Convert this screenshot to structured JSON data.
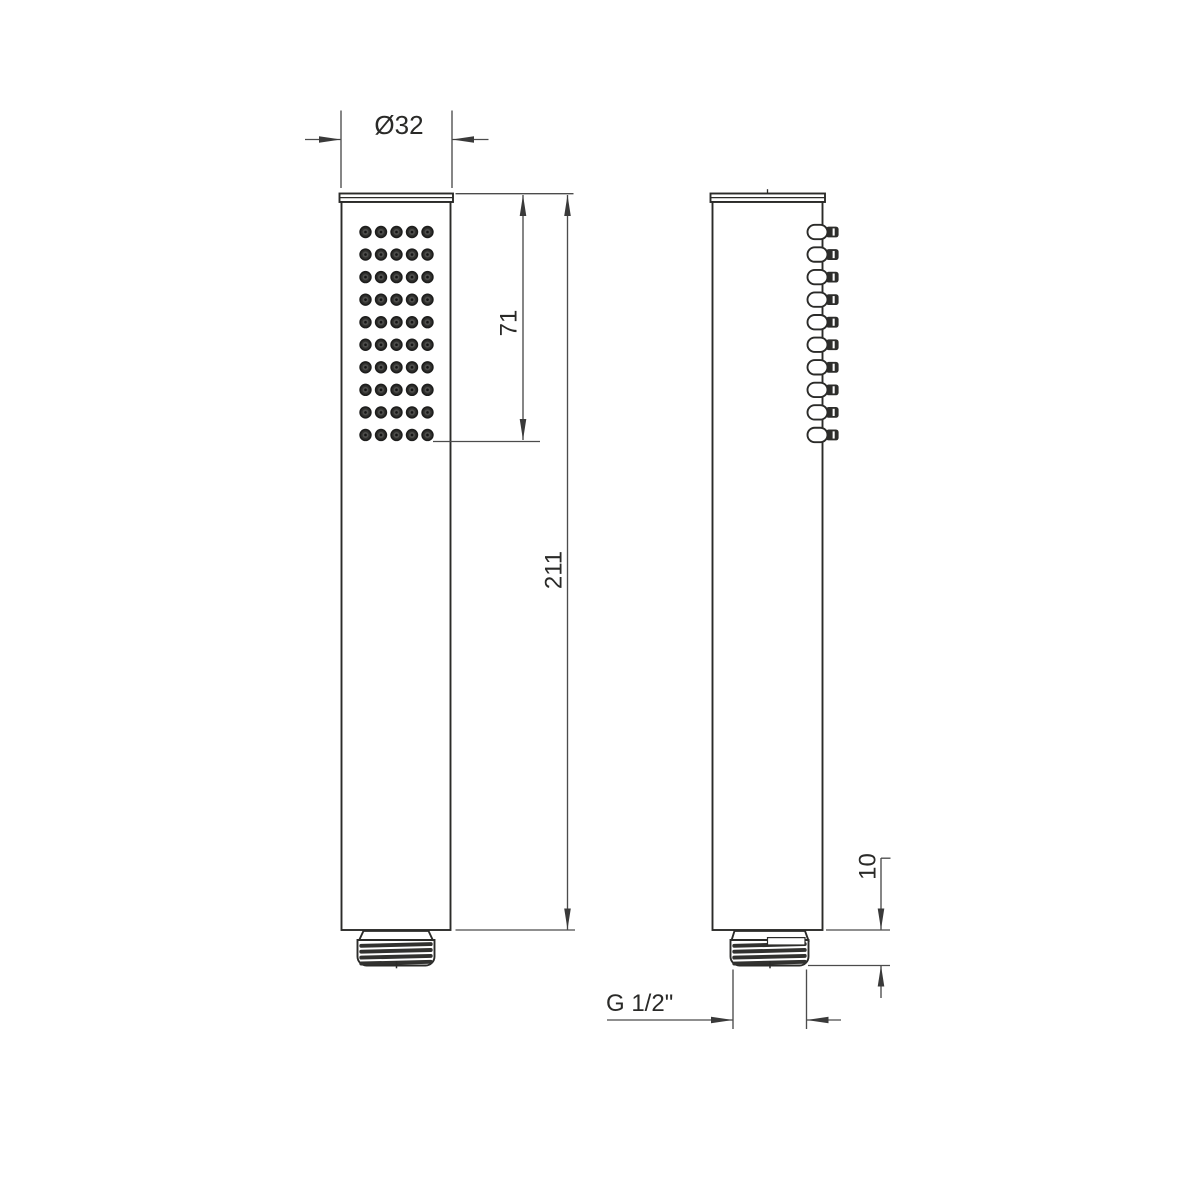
{
  "document": {
    "type": "technical-drawing",
    "subject": "hand-shower",
    "background_color": "#ffffff",
    "object_line_color": "#2b2b29",
    "dimension_line_color": "#4c4c4c",
    "text_color": "#2a2a28"
  },
  "views": {
    "front": {
      "label": "front-view",
      "spray_grid": {
        "rows": 10,
        "cols": 5
      }
    },
    "side": {
      "label": "side-view",
      "nozzles": {
        "count": 10
      }
    }
  },
  "dimensions": {
    "diameter": {
      "label": "Ø32"
    },
    "spray_face_length": {
      "label": "71"
    },
    "overall_length": {
      "label": "211"
    },
    "thread_length": {
      "label": "10"
    },
    "thread_spec": {
      "label": "G 1/2\""
    }
  }
}
